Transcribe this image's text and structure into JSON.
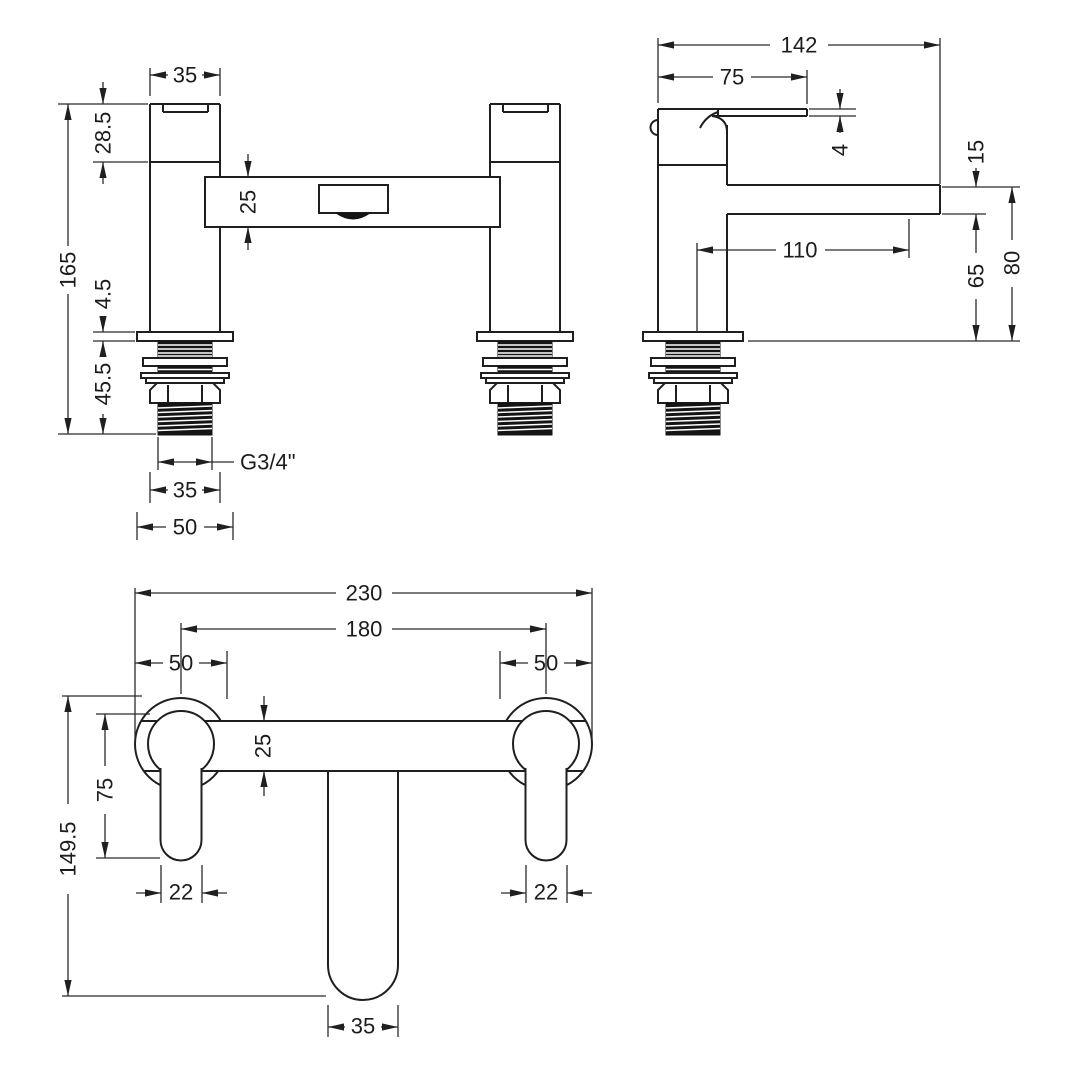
{
  "drawing": {
    "type": "bath-filler-tap-dimension-drawing",
    "units": "mm",
    "colors": {
      "ink": "#1f1f1f",
      "background": "#ffffff"
    },
    "views": {
      "front": {
        "dims": {
          "pillar_width": "35",
          "head_height": "28.5",
          "total_height": "165",
          "crossbar_depth": "25",
          "flange_thickness": "4.5",
          "tail_length": "45.5",
          "thread_size": "G3/4\"",
          "thread_width": "35",
          "flange_width": "50"
        }
      },
      "side": {
        "dims": {
          "overall_depth": "142",
          "handle_length": "75",
          "lever_thickness": "4",
          "spout_thickness": "15",
          "spout_projection": "110",
          "under_spout_height": "65",
          "spout_top_height": "80"
        }
      },
      "plan": {
        "dims": {
          "overall_width": "230",
          "hole_centres": "180",
          "left_boss_diameter": "50",
          "right_boss_diameter": "50",
          "crossbar_depth": "25",
          "handle_length": "75",
          "overall_depth": "149.5",
          "left_handle_width": "22",
          "right_handle_width": "22",
          "spout_width": "35"
        }
      }
    }
  }
}
